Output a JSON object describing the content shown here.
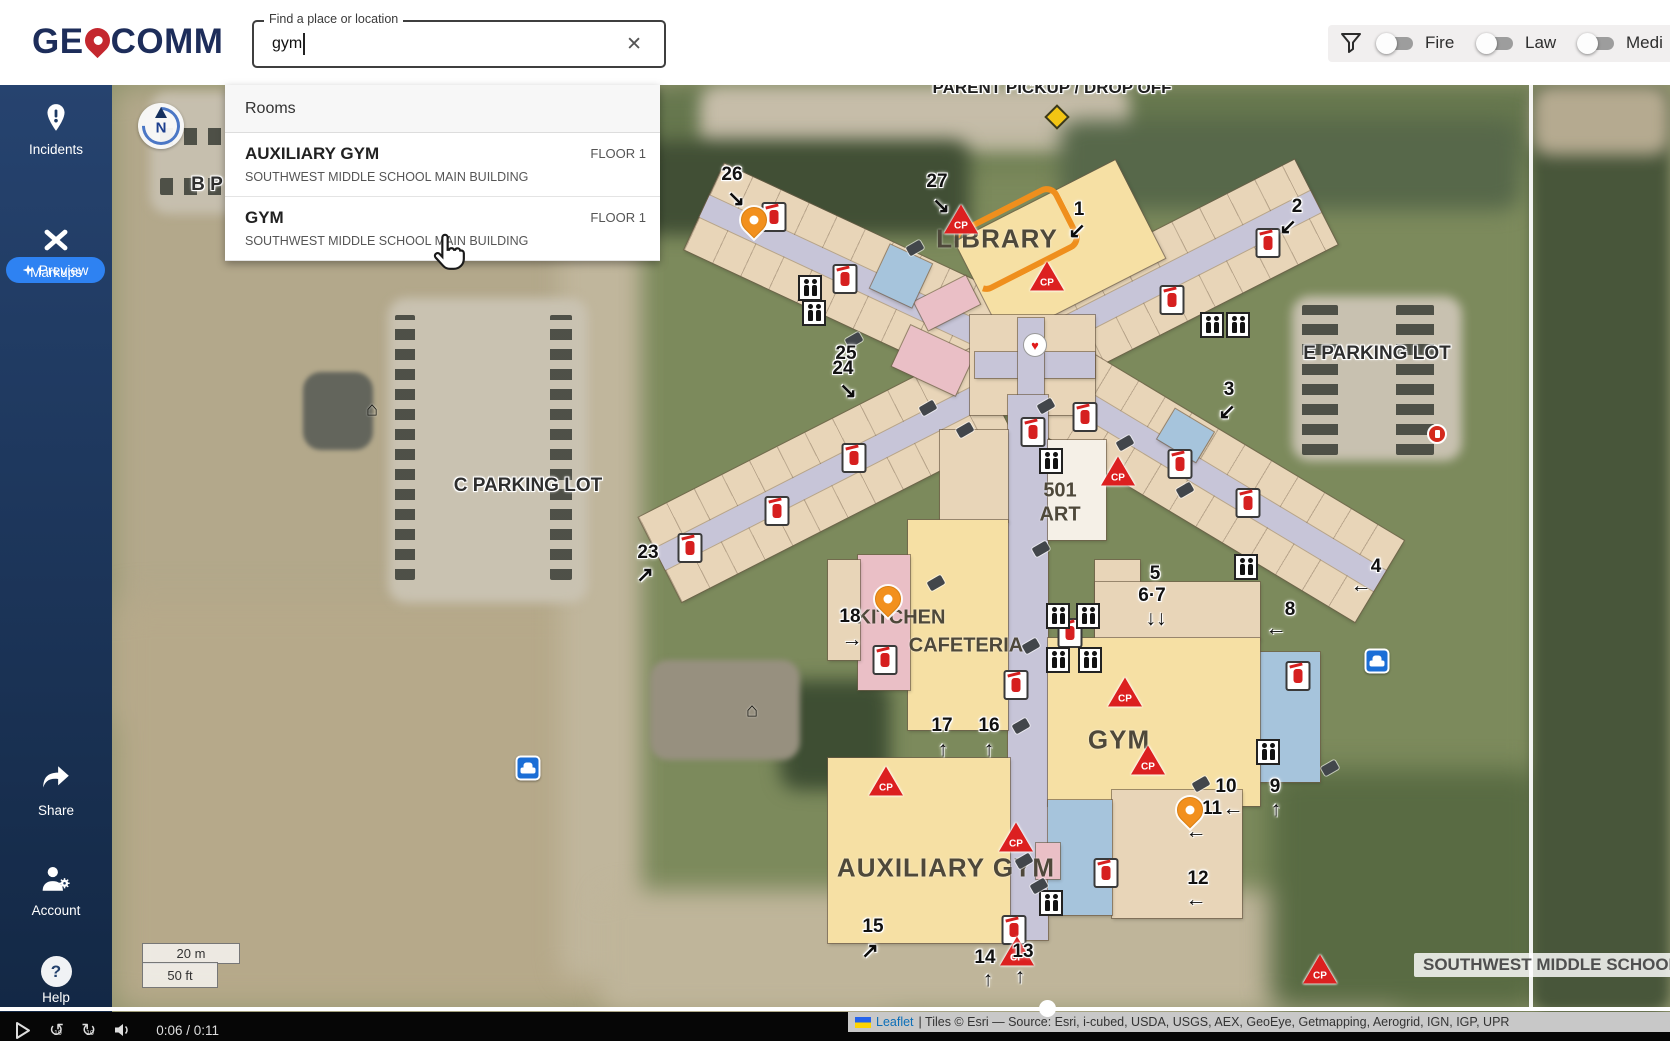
{
  "header": {
    "logo": {
      "part1": "GE",
      "part2": "COMM"
    },
    "search": {
      "label": "Find a place or location",
      "value": "gym",
      "clear": "✕"
    },
    "filters": {
      "toggles": [
        {
          "label": "Fire"
        },
        {
          "label": "Law"
        },
        {
          "label": "Medi"
        }
      ]
    }
  },
  "sidebar": {
    "incidents": "Incidents",
    "preview": "Preview",
    "markups": "Markups",
    "share": "Share",
    "account": "Account",
    "help": "Help",
    "help_glyph": "?"
  },
  "dropdown": {
    "section": "Rooms",
    "results": [
      {
        "title": "AUXILIARY GYM",
        "floor": "FLOOR 1",
        "subtitle": "SOUTHWEST MIDDLE SCHOOL MAIN BUILDING"
      },
      {
        "title": "GYM",
        "floor": "FLOOR 1",
        "subtitle": "SOUTHWEST MIDDLE SCHOOL MAIN BUILDING"
      }
    ]
  },
  "map": {
    "compass_n": "N",
    "cp_label": "CP",
    "glyphs": {
      "heart": "♥",
      "house": "⌂"
    },
    "school_badge": "SOUTHWEST MIDDLE SCHOOL",
    "scale": {
      "metric": "20 m",
      "imperial": "50 ft"
    },
    "attribution": {
      "leaflet": "Leaflet",
      "rest": " | Tiles © Esri — Source: Esri, i-cubed, USDA, USGS, AEX, GeoEye, Getmapping, Aerogrid, IGN, IGP, UPR"
    },
    "labels": [
      {
        "text": "PARENT PICKUP / DROP OFF",
        "x": 1052,
        "y": 88,
        "cls": "lbl-ground lbl-top"
      },
      {
        "text": "B P",
        "x": 207,
        "y": 185,
        "cls": "lbl-ground"
      },
      {
        "text": "C PARKING LOT",
        "x": 528,
        "y": 486,
        "cls": "lbl-ground"
      },
      {
        "text": "E PARKING LOT",
        "x": 1377,
        "y": 354,
        "cls": "lbl-ground"
      },
      {
        "text": "LIBRARY",
        "x": 997,
        "y": 239,
        "cls": "lbl-room lbl-lg"
      },
      {
        "text": "501",
        "x": 1060,
        "y": 491,
        "cls": "lbl-room"
      },
      {
        "text": "ART",
        "x": 1060,
        "y": 515,
        "cls": "lbl-room"
      },
      {
        "text": "KITCHEN",
        "x": 901,
        "y": 618,
        "cls": "lbl-room"
      },
      {
        "text": "CAFETERIA",
        "x": 966,
        "y": 646,
        "cls": "lbl-room"
      },
      {
        "text": "GYM",
        "x": 1119,
        "y": 740,
        "cls": "lbl-room lbl-lg"
      },
      {
        "text": "AUXILIARY GYM",
        "x": 946,
        "y": 868,
        "cls": "lbl-room lbl-lg"
      }
    ],
    "exits": [
      {
        "n": "26",
        "x": 732,
        "y": 175,
        "a": "↘",
        "ax": 736,
        "ay": 199
      },
      {
        "n": "27",
        "x": 937,
        "y": 182,
        "a": "↘",
        "ax": 941,
        "ay": 206
      },
      {
        "n": "1",
        "x": 1079,
        "y": 210,
        "a": "↙",
        "ax": 1077,
        "ay": 231
      },
      {
        "n": "2",
        "x": 1297,
        "y": 207,
        "a": "↙",
        "ax": 1288,
        "ay": 227
      },
      {
        "n": "25",
        "x": 846,
        "y": 354
      },
      {
        "n": "24",
        "x": 843,
        "y": 369,
        "a": "↘",
        "ax": 848,
        "ay": 391
      },
      {
        "n": "3",
        "x": 1229,
        "y": 390,
        "a": "↙",
        "ax": 1227,
        "ay": 412
      },
      {
        "n": "23",
        "x": 648,
        "y": 553,
        "a": "↗",
        "ax": 645,
        "ay": 575
      },
      {
        "n": "4",
        "x": 1376,
        "y": 567,
        "a": "←",
        "ax": 1361,
        "ay": 586
      },
      {
        "n": "5",
        "x": 1155,
        "y": 574
      },
      {
        "n": "6·7",
        "x": 1152,
        "y": 596,
        "a": "↓↓",
        "ax": 1156,
        "ay": 619
      },
      {
        "n": "8",
        "x": 1290,
        "y": 610,
        "a": "←",
        "ax": 1276,
        "ay": 629
      },
      {
        "n": "18",
        "x": 850,
        "y": 617,
        "a": "→",
        "ax": 852,
        "ay": 640
      },
      {
        "n": "17",
        "x": 942,
        "y": 726,
        "a": "↑",
        "ax": 943,
        "ay": 750
      },
      {
        "n": "16",
        "x": 989,
        "y": 726,
        "a": "↑",
        "ax": 989,
        "ay": 750
      },
      {
        "n": "10",
        "x": 1226,
        "y": 787
      },
      {
        "n": "11",
        "x": 1212,
        "y": 809,
        "a": "←",
        "ax": 1233,
        "ay": 809
      },
      {
        "n": "9",
        "x": 1275,
        "y": 787,
        "a": "↑",
        "ax": 1276,
        "ay": 810
      },
      {
        "n": "12",
        "x": 1198,
        "y": 879,
        "a": "←",
        "ax": 1196,
        "ay": 900
      },
      {
        "n": "15",
        "x": 873,
        "y": 927,
        "a": "↗",
        "ax": 870,
        "ay": 951
      },
      {
        "n": "14",
        "x": 985,
        "y": 958,
        "a": "↑",
        "ax": 988,
        "ay": 980
      },
      {
        "n": "13",
        "x": 1023,
        "y": 952,
        "a": "↑",
        "ax": 1020,
        "ay": 977
      }
    ],
    "extra_arrows": [
      {
        "a": "←",
        "x": 1196,
        "y": 832
      }
    ],
    "icons": [
      {
        "t": "pin",
        "x": 754,
        "y": 237
      },
      {
        "t": "pin",
        "x": 888,
        "y": 616
      },
      {
        "t": "pin",
        "x": 1190,
        "y": 827
      },
      {
        "t": "ext",
        "x": 774,
        "y": 217
      },
      {
        "t": "ext",
        "x": 845,
        "y": 279
      },
      {
        "t": "ext",
        "x": 854,
        "y": 458
      },
      {
        "t": "ext",
        "x": 777,
        "y": 511
      },
      {
        "t": "ext",
        "x": 690,
        "y": 548
      },
      {
        "t": "ext",
        "x": 1172,
        "y": 300
      },
      {
        "t": "ext",
        "x": 1268,
        "y": 243
      },
      {
        "t": "ext",
        "x": 1033,
        "y": 432
      },
      {
        "t": "ext",
        "x": 1085,
        "y": 417
      },
      {
        "t": "ext",
        "x": 1180,
        "y": 464
      },
      {
        "t": "ext",
        "x": 1248,
        "y": 503
      },
      {
        "t": "ext",
        "x": 1070,
        "y": 633
      },
      {
        "t": "ext",
        "x": 885,
        "y": 660
      },
      {
        "t": "ext",
        "x": 1016,
        "y": 685
      },
      {
        "t": "ext",
        "x": 1106,
        "y": 873
      },
      {
        "t": "ext",
        "x": 1014,
        "y": 930
      },
      {
        "t": "ext",
        "x": 1298,
        "y": 676
      },
      {
        "t": "cp",
        "x": 961,
        "y": 219
      },
      {
        "t": "cp",
        "x": 1047,
        "y": 247
      },
      {
        "t": "cp",
        "x": 1118,
        "y": 413
      },
      {
        "t": "cp",
        "x": 1125,
        "y": 605
      },
      {
        "t": "cp",
        "x": 1148,
        "y": 644
      },
      {
        "t": "cp",
        "x": 886,
        "y": 636
      },
      {
        "t": "cp",
        "x": 1016,
        "y": 663
      },
      {
        "t": "cp",
        "x": 1017,
        "y": 748
      },
      {
        "t": "cp",
        "x": 1320,
        "y": 737
      },
      {
        "t": "wc",
        "x": 810,
        "y": 288
      },
      {
        "t": "wc",
        "x": 814,
        "y": 313
      },
      {
        "t": "wc",
        "x": 1051,
        "y": 461
      },
      {
        "t": "wc",
        "x": 1246,
        "y": 567
      },
      {
        "t": "wc",
        "x": 1058,
        "y": 616
      },
      {
        "t": "wc",
        "x": 1088,
        "y": 616
      },
      {
        "t": "wc",
        "x": 1058,
        "y": 660
      },
      {
        "t": "wc",
        "x": 1090,
        "y": 660
      },
      {
        "t": "wc",
        "x": 1051,
        "y": 903
      },
      {
        "t": "wc",
        "x": 1212,
        "y": 325
      },
      {
        "t": "wc",
        "x": 1238,
        "y": 325
      },
      {
        "t": "wc",
        "x": 1268,
        "y": 752
      },
      {
        "t": "cam",
        "x": 907,
        "y": 243
      },
      {
        "t": "cam",
        "x": 846,
        "y": 335
      },
      {
        "t": "cam",
        "x": 920,
        "y": 403
      },
      {
        "t": "cam",
        "x": 957,
        "y": 425
      },
      {
        "t": "cam",
        "x": 1038,
        "y": 401
      },
      {
        "t": "cam",
        "x": 1117,
        "y": 438
      },
      {
        "t": "cam",
        "x": 1177,
        "y": 485
      },
      {
        "t": "cam",
        "x": 1033,
        "y": 544
      },
      {
        "t": "cam",
        "x": 928,
        "y": 578
      },
      {
        "t": "cam",
        "x": 1023,
        "y": 641
      },
      {
        "t": "cam",
        "x": 1013,
        "y": 721
      },
      {
        "t": "cam",
        "x": 1016,
        "y": 856
      },
      {
        "t": "cam",
        "x": 1031,
        "y": 881
      },
      {
        "t": "cam",
        "x": 1193,
        "y": 779
      },
      {
        "t": "cam",
        "x": 1322,
        "y": 763
      },
      {
        "t": "aed",
        "x": 1035,
        "y": 345
      },
      {
        "t": "hydrant",
        "x": 1437,
        "y": 434
      },
      {
        "t": "car",
        "x": 528,
        "y": 507
      },
      {
        "t": "car",
        "x": 1377,
        "y": 375
      },
      {
        "t": "sign",
        "x": 1048,
        "y": 108
      },
      {
        "t": "house",
        "x": 372,
        "y": 410
      },
      {
        "t": "house",
        "x": 752,
        "y": 711
      }
    ]
  },
  "video": {
    "time": "0:06 / 0:11",
    "skip": "10"
  }
}
